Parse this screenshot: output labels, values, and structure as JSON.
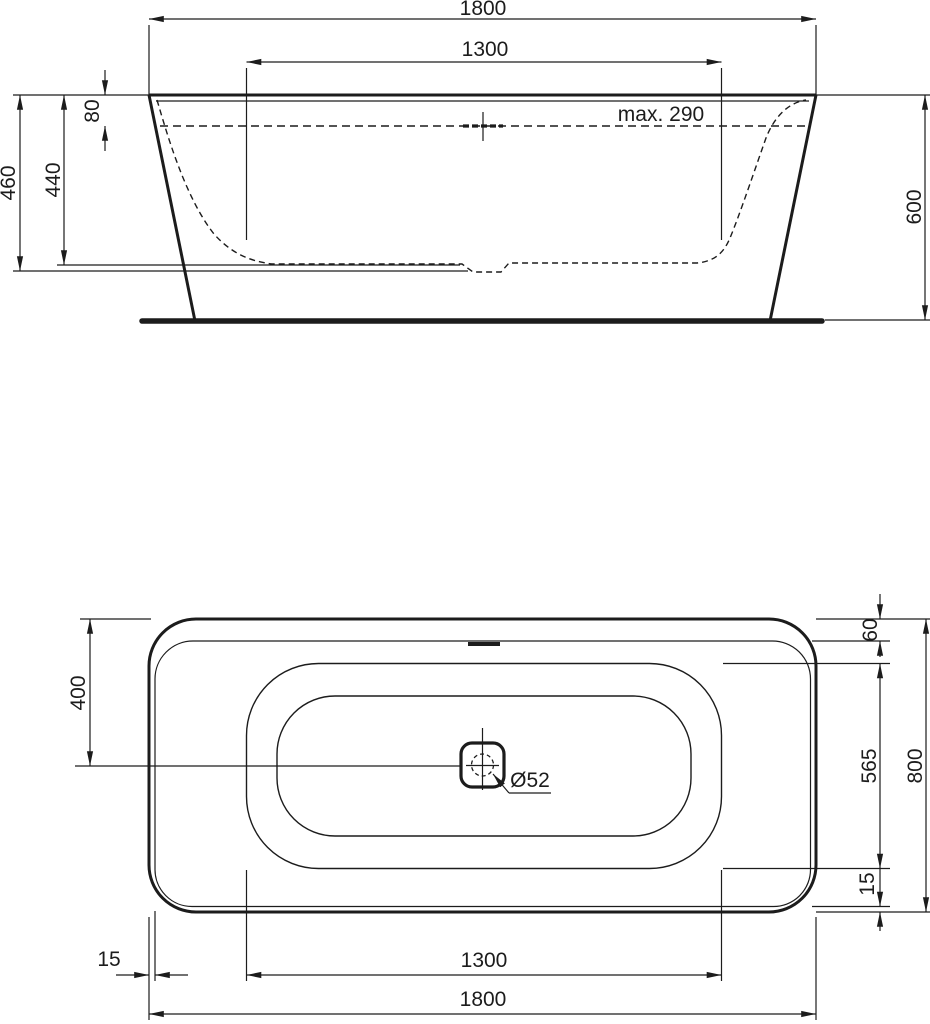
{
  "drawing_type": "bathtub technical dimension drawing",
  "colors": {
    "line": "#1c1c1c",
    "background": "#ffffff"
  },
  "side_view": {
    "dimensions": {
      "overall_length": "1800",
      "interior_length": "1300",
      "rim_to_waterline": "80",
      "interior_depth": "440",
      "interior_depth_to_sump": "460",
      "max_fill": "max. 290",
      "overall_height": "600"
    }
  },
  "plan_view": {
    "dimensions": {
      "edge_to_centerline": "400",
      "rim_width_top": "60",
      "interior_width": "565",
      "overall_width": "800",
      "rim_width_side": "15",
      "rim_width_bottom": "15",
      "interior_length": "1300",
      "overall_length": "1800",
      "drain_diameter": "Ø52"
    }
  }
}
